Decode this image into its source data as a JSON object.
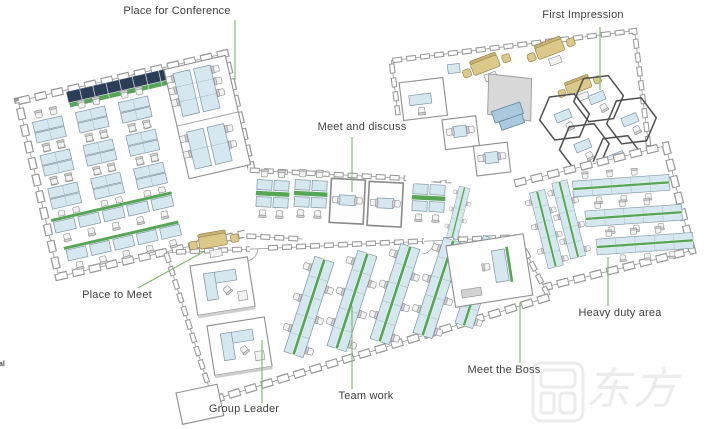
{
  "labels": {
    "conference": "Place for Conference",
    "first_impression": "First Impression",
    "meet_discuss": "Meet and discuss",
    "place_to_meet": "Place to Meet",
    "group_leader": "Group Leader",
    "team_work": "Team work",
    "meet_boss": "Meet the Boss",
    "heavy_duty": "Heavy duty area",
    "edge_fragment": "al"
  },
  "watermark": {
    "characters": "东方华奥"
  },
  "colors": {
    "desk": "#d5e7ef",
    "desk_edge": "#7d95a2",
    "divider": "#57a657",
    "cabinet": "#2c3e57",
    "sofa": "#dcc98a",
    "sofa_dark": "#c9b374",
    "screen": "#d8d8d8",
    "reception_desk": "#a9c9dc",
    "wall": "#979797",
    "leader": "#7fb569",
    "label": "#404040",
    "watermark": "#ececec"
  }
}
